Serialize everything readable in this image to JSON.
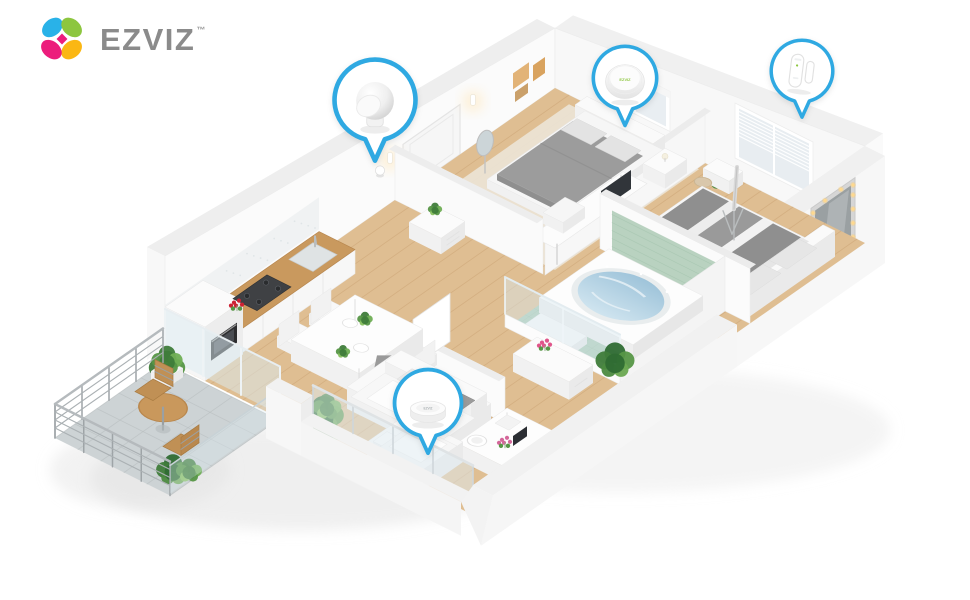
{
  "brand": {
    "name": "EZVIZ",
    "trademark": "™"
  },
  "callouts": [
    {
      "id": "motion-sensor",
      "name": "motion-sensor"
    },
    {
      "id": "alarm-hub",
      "name": "smart-alarm-hub",
      "label": "EZVIZ"
    },
    {
      "id": "door-sensor",
      "name": "door-window-sensor"
    },
    {
      "id": "home-hub",
      "name": "smart-home-hub",
      "label": "EZVIZ"
    }
  ],
  "scene": {
    "rooms": [
      "entry-hall",
      "bedroom-1",
      "bedroom-2",
      "bathroom",
      "kitchen",
      "dining-area",
      "living-room",
      "balcony"
    ]
  },
  "colors": {
    "accent": "#2FA9E2",
    "logo_blue": "#29B2E8",
    "logo_green": "#8DC63F",
    "logo_pink": "#EC1D7C",
    "logo_yellow": "#FBB713",
    "logo_text": "#8B8B8B",
    "wood_floor": "#DFBE92",
    "wood_plank_line": "#C3996A",
    "wood_counter": "#C9995E",
    "tile_green": "#ABCBB4",
    "tile_wall": "#B5D0BD",
    "water_blue": "#A6C8DC",
    "balcony_tile": "#CDD3D5",
    "wall_white": "#FBFBFB",
    "blanket_gray": "#9C9C9C",
    "plant_green": "#569646"
  }
}
